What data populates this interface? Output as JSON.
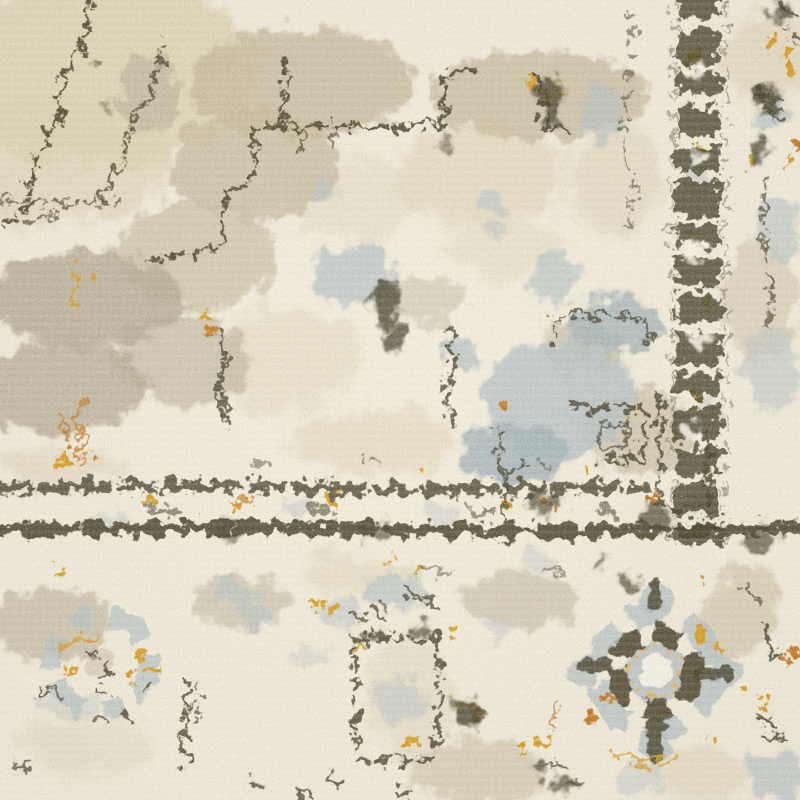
{
  "scene": {
    "description": "Close-up photograph of a distressed vintage-style area rug: corner section showing an ivory field with a faded charcoal medallion outline, a dark speckled guard band running vertically on the right and horizontally across the lower third, and an outer border with round rosette medallions in slate blue, charcoal and gold",
    "surface": "cut-pile carpet, fuzzy texture with horizontal pile rows",
    "motifs": [
      {
        "name": "medallion-outline-field",
        "area": "upper-left two-thirds",
        "style": "stepped broken charcoal lines over beige and taupe abrash patches"
      },
      {
        "name": "vertical-guard-band",
        "area": "x≈672-724, top to y≈545",
        "style": "dark speckled chain with gold flecks"
      },
      {
        "name": "horizontal-guard-band",
        "area": "y≈485-540, full width",
        "style": "two broken charcoal rules with tan, gold and slate ornaments between"
      },
      {
        "name": "corner-key-motif",
        "area": "junction of the two bands",
        "style": "rectangular hook outlines with tan fill"
      },
      {
        "name": "wreath-rosette",
        "center": [
          100,
          663
        ],
        "style": "faded slate-blue ring with gold sprigs and charcoal flecks"
      },
      {
        "name": "panel-motif",
        "center": [
          396,
          698
        ],
        "style": "broken charcoal rectangle with slate and gold flecks"
      },
      {
        "name": "ring-rosette",
        "center": [
          655,
          672
        ],
        "style": "slate-blue scalloped ring, charcoal inner ring with cross arms, cream eye with amber dots"
      },
      {
        "name": "outer-border-sprigs",
        "area": "right edge and bottom edge",
        "style": "charcoal sprigs, slate patches, gold and rust dots"
      }
    ]
  },
  "palette": {
    "cream": "#f0e9d6",
    "cream_light": "#f8f3e6",
    "cream_shadow": "#e0d6bd",
    "beige": "#d8caa9",
    "tan": "#c1b294",
    "taupe": "#a89b84",
    "blue_gray": "#aeb9bd",
    "blue_gray_deep": "#96a7ae",
    "charcoal": "#36311f",
    "charcoal_soft": "#4c463a",
    "gold": "#d2921e",
    "amber": "#e2ac3f",
    "orange": "#bc6c1d",
    "white_fuzz": "#fffdf0",
    "dark_fuzz": "#3a3322"
  }
}
